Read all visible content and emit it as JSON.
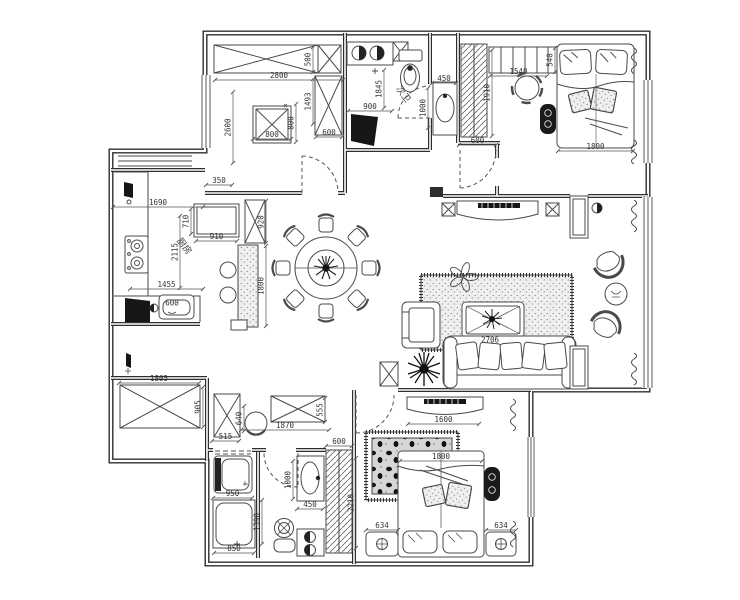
{
  "title": "apartment-floor-plan",
  "colors": {
    "background": "#ffffff",
    "wall": "#2e2e2e",
    "furniture_line": "#4a4a4a",
    "dimension_text": "#333333",
    "dark_fill": "#161616"
  },
  "room_labels": [
    {
      "text": "厨房",
      "x": 182,
      "y": 248,
      "rot": 52
    },
    {
      "text": "次卫",
      "x": 401,
      "y": 96,
      "rot": 52
    }
  ],
  "dimensions": [
    {
      "t": "2800",
      "x1": 215,
      "y1": 80,
      "x2": 343,
      "y2": 80
    },
    {
      "t": "500",
      "x1": 313,
      "y1": 47,
      "x2": 313,
      "y2": 72
    },
    {
      "t": "2600",
      "x1": 233,
      "y1": 92,
      "x2": 233,
      "y2": 163
    },
    {
      "t": "1493",
      "x1": 313,
      "y1": 79,
      "x2": 313,
      "y2": 124
    },
    {
      "t": "800",
      "x1": 253,
      "y1": 139,
      "x2": 291,
      "y2": 139
    },
    {
      "t": "800",
      "x1": 296,
      "y1": 104,
      "x2": 296,
      "y2": 142
    },
    {
      "t": "600",
      "x1": 316,
      "y1": 137,
      "x2": 342,
      "y2": 137
    },
    {
      "t": "350",
      "x1": 206,
      "y1": 185,
      "x2": 232,
      "y2": 185
    },
    {
      "t": "900",
      "x1": 348,
      "y1": 111,
      "x2": 392,
      "y2": 111
    },
    {
      "t": "1845",
      "x1": 384,
      "y1": 70,
      "x2": 384,
      "y2": 108
    },
    {
      "t": "450",
      "x1": 432,
      "y1": 83,
      "x2": 456,
      "y2": 83
    },
    {
      "t": "1000",
      "x1": 428,
      "y1": 88,
      "x2": 428,
      "y2": 128
    },
    {
      "t": "1910",
      "x1": 492,
      "y1": 50,
      "x2": 492,
      "y2": 136
    },
    {
      "t": "600",
      "x1": 459,
      "y1": 145,
      "x2": 496,
      "y2": 145
    },
    {
      "t": "1540",
      "x1": 490,
      "y1": 76,
      "x2": 547,
      "y2": 76
    },
    {
      "t": "540",
      "x1": 555,
      "y1": 48,
      "x2": 555,
      "y2": 72
    },
    {
      "t": "1800",
      "x1": 558,
      "y1": 151,
      "x2": 633,
      "y2": 151
    },
    {
      "t": "1690",
      "x1": 113,
      "y1": 207,
      "x2": 203,
      "y2": 207
    },
    {
      "t": "2115",
      "x1": 180,
      "y1": 216,
      "x2": 180,
      "y2": 288
    },
    {
      "t": "710",
      "x1": 191,
      "y1": 209,
      "x2": 191,
      "y2": 234
    },
    {
      "t": "910",
      "x1": 196,
      "y1": 241,
      "x2": 237,
      "y2": 241
    },
    {
      "t": "1455",
      "x1": 130,
      "y1": 289,
      "x2": 203,
      "y2": 289
    },
    {
      "t": "600",
      "x1": 172,
      "y1": 303,
      "x2": 172,
      "y2": 303
    },
    {
      "t": "920",
      "x1": 266,
      "y1": 201,
      "x2": 266,
      "y2": 243
    },
    {
      "t": "1800",
      "x1": 266,
      "y1": 246,
      "x2": 266,
      "y2": 326
    },
    {
      "t": "2706",
      "x1": 490,
      "y1": 340,
      "x2": 490,
      "y2": 340
    },
    {
      "t": "1600",
      "x1": 408,
      "y1": 424,
      "x2": 479,
      "y2": 424
    },
    {
      "t": "1800",
      "x1": 400,
      "y1": 461,
      "x2": 482,
      "y2": 461
    },
    {
      "t": "634",
      "x1": 366,
      "y1": 530,
      "x2": 398,
      "y2": 530
    },
    {
      "t": "634",
      "x1": 486,
      "y1": 530,
      "x2": 516,
      "y2": 530
    },
    {
      "t": "1805",
      "x1": 119,
      "y1": 383,
      "x2": 199,
      "y2": 383
    },
    {
      "t": "905",
      "x1": 203,
      "y1": 387,
      "x2": 203,
      "y2": 427
    },
    {
      "t": "515",
      "x1": 212,
      "y1": 441,
      "x2": 239,
      "y2": 441
    },
    {
      "t": "1870",
      "x1": 241,
      "y1": 430,
      "x2": 329,
      "y2": 430
    },
    {
      "t": "555",
      "x1": 325,
      "y1": 398,
      "x2": 325,
      "y2": 422
    },
    {
      "t": "640",
      "x1": 244,
      "y1": 406,
      "x2": 244,
      "y2": 431
    },
    {
      "t": "950",
      "x1": 213,
      "y1": 498,
      "x2": 252,
      "y2": 498
    },
    {
      "t": "850",
      "x1": 214,
      "y1": 553,
      "x2": 254,
      "y2": 553
    },
    {
      "t": "1390",
      "x1": 262,
      "y1": 500,
      "x2": 262,
      "y2": 544
    },
    {
      "t": "450",
      "x1": 297,
      "y1": 509,
      "x2": 323,
      "y2": 509
    },
    {
      "t": "1000",
      "x1": 293,
      "y1": 461,
      "x2": 293,
      "y2": 499
    },
    {
      "t": "600",
      "x1": 326,
      "y1": 446,
      "x2": 352,
      "y2": 446
    },
    {
      "t": "2210",
      "x1": 356,
      "y1": 458,
      "x2": 356,
      "y2": 548
    }
  ]
}
